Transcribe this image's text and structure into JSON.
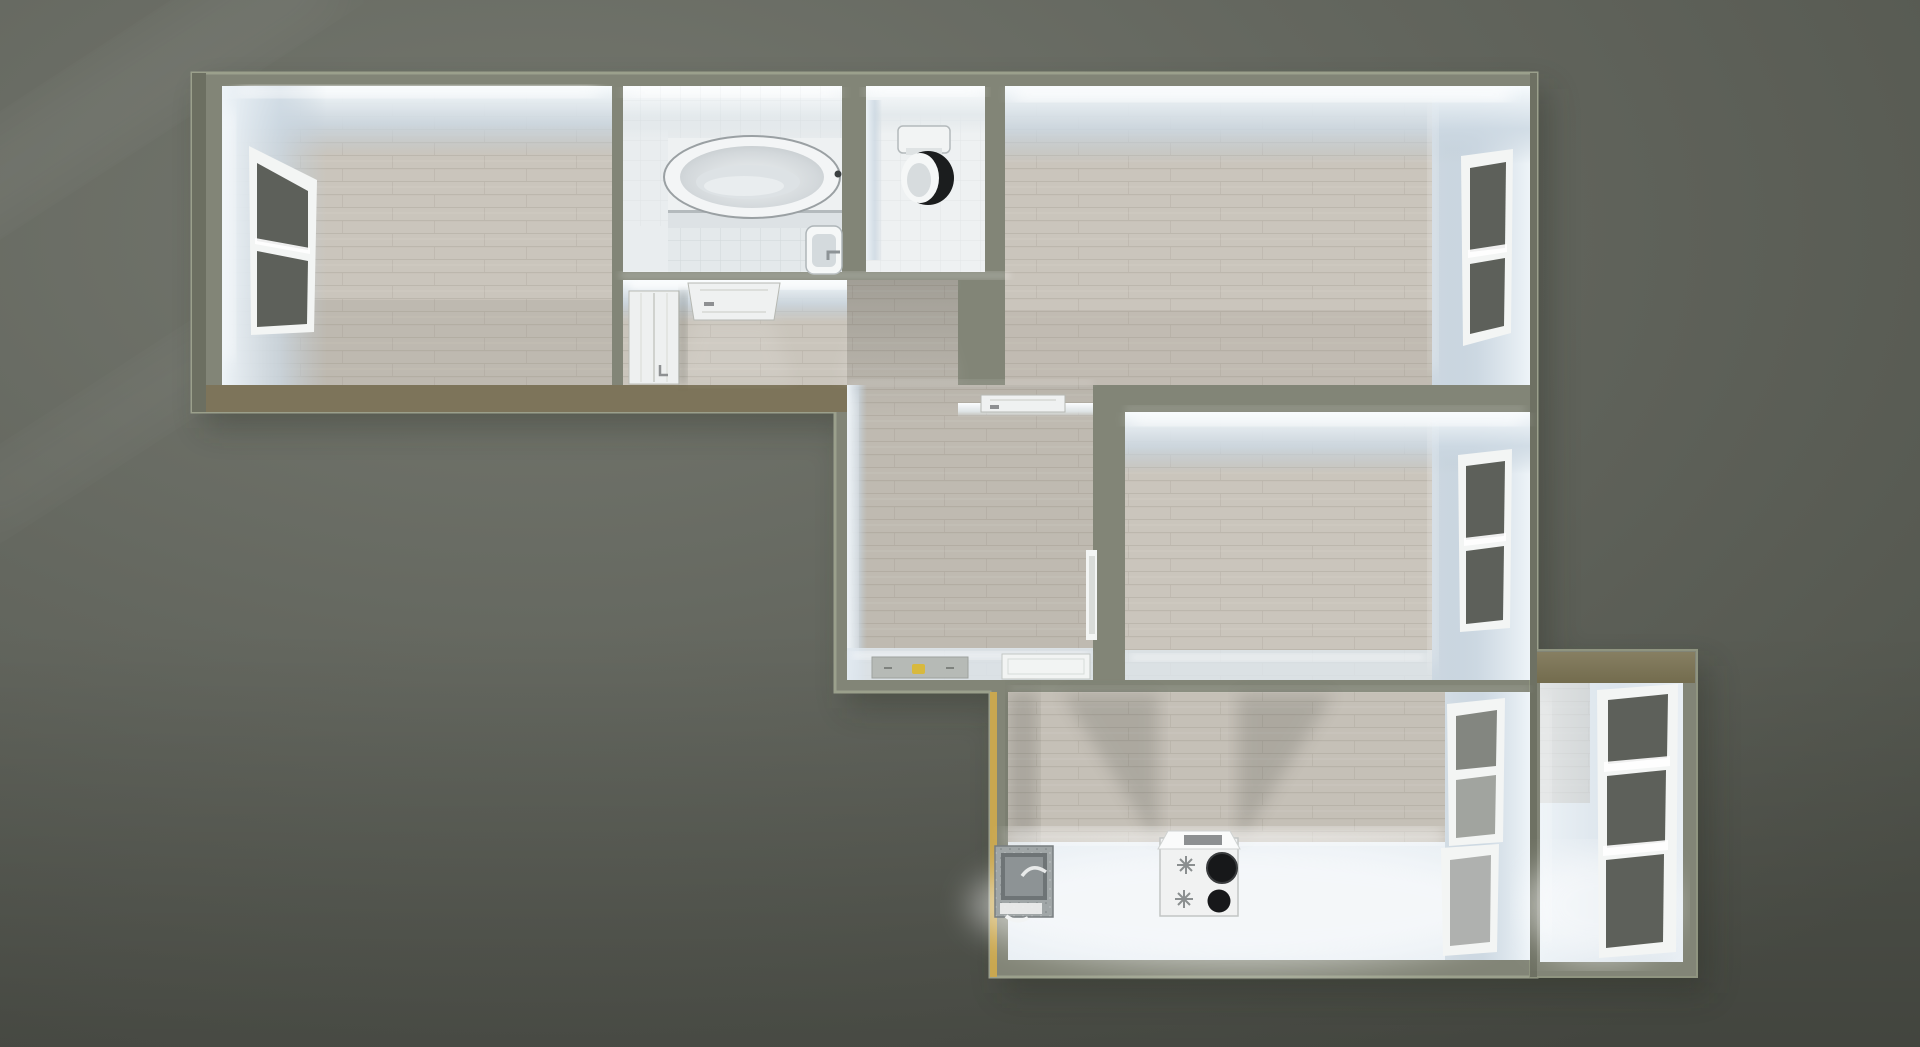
{
  "scene": {
    "title": "3D top-down dollhouse render of an apartment floor plan",
    "view": "orthographic top-down with slight perspective, evening interior lighting",
    "rooms": [
      {
        "id": "bedroom-west",
        "name": "West bedroom (top-left), plank floor, window on west wall"
      },
      {
        "id": "bathroom",
        "name": "Bathroom with oval bathtub on platform and corner wash basin"
      },
      {
        "id": "wc",
        "name": "WC with toilet (open dark lid) against north wall"
      },
      {
        "id": "bedroom-north-east",
        "name": "North-east bedroom (top-right), plank floor, window on east wall"
      },
      {
        "id": "corridor",
        "name": "Corridor with wardrobe and two doors on north wall"
      },
      {
        "id": "living-room",
        "name": "Central living room with doorway mats and interior doors"
      },
      {
        "id": "bedroom-east",
        "name": "East bedroom (middle-right), window on east wall"
      },
      {
        "id": "kitchen",
        "name": "Kitchen with free-standing stove, sink unit and two east windows"
      },
      {
        "id": "balcony",
        "name": "Balcony (bottom-right annex) with full-height triple window"
      }
    ],
    "fixtures": [
      {
        "id": "bathtub",
        "name": "oval bathtub with faucet"
      },
      {
        "id": "wash-basin",
        "name": "bathroom wash basin"
      },
      {
        "id": "toilet",
        "name": "toilet with tank and open dark lid"
      },
      {
        "id": "wardrobe",
        "name": "white wardrobe in corridor"
      },
      {
        "id": "door-north-1",
        "name": "interior door leaf, corridor north wall (west)"
      },
      {
        "id": "door-north-2",
        "name": "interior door leaf, corridor north wall (east)"
      },
      {
        "id": "door-living-north",
        "name": "door leaf on living room north wall"
      },
      {
        "id": "door-living-east",
        "name": "door frame in living room east wall"
      },
      {
        "id": "kitchen-sink",
        "name": "granite kitchen sink unit with faucet"
      },
      {
        "id": "stove",
        "name": "white stove with two dark burners and two knobs"
      },
      {
        "id": "gray-mat",
        "name": "gray floor mat with small yellow object"
      },
      {
        "id": "white-mat",
        "name": "white door mat / threshold panel"
      }
    ],
    "windows": [
      {
        "id": "window-west-bedroom",
        "panes": 2
      },
      {
        "id": "window-ne-bedroom",
        "panes": 2
      },
      {
        "id": "window-east-bedroom",
        "panes": 2
      },
      {
        "id": "window-kitchen-upper",
        "panes": 2
      },
      {
        "id": "window-kitchen-lower",
        "panes": 1
      },
      {
        "id": "window-balcony",
        "panes": 3
      }
    ],
    "colors": {
      "bg-base": "#64675f",
      "bg-light": "#757870",
      "bg-dark": "#53564e",
      "wall-top": "#828577",
      "wall-top-dark": "#6f7264",
      "wall-highlight": "#a2a795",
      "wall-tan": "#7d745a",
      "balcony-tan": "#93876a",
      "accent-gold": "#c9a750",
      "plank": "#cac5bc",
      "plank-dim": "#bfbab1",
      "bright-floor": "#e9eff4",
      "tile": "#e4e9eb",
      "face-light": "#f6fafc",
      "glass": "#5d605a",
      "fixture-white": "#f4f6f6",
      "burner-black": "#1b1d1e",
      "granite": "#a0a6a7",
      "mat-yellow": "#d8b93e"
    }
  }
}
